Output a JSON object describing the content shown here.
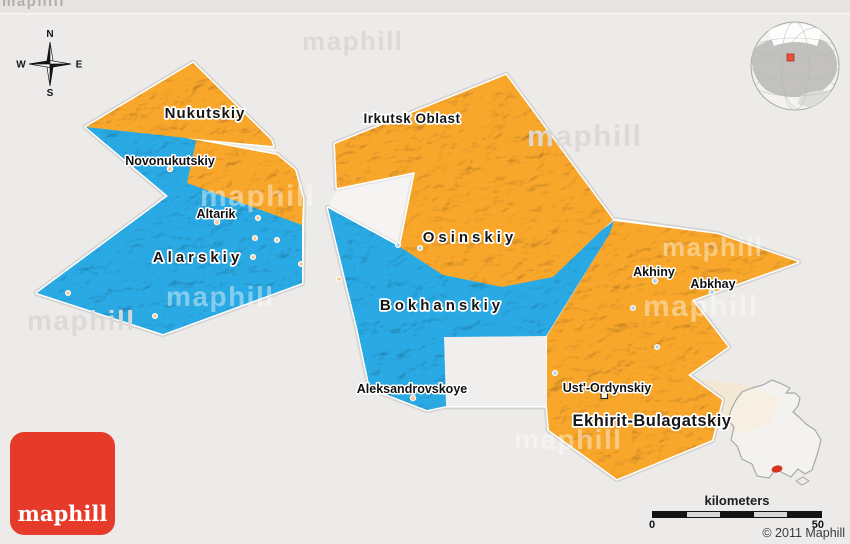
{
  "compass": {
    "n": "N",
    "e": "E",
    "s": "S",
    "w": "W"
  },
  "map_labels": {
    "districts": [
      {
        "name": "Nukutskiy"
      },
      {
        "name": "Irkutsk Oblast"
      },
      {
        "name": "Osinskiy"
      },
      {
        "name": "Alarskiy"
      },
      {
        "name": "Bokhanskiy"
      },
      {
        "name": "Ekhirit-Bulagatskiy"
      }
    ],
    "towns": [
      {
        "name": "Novonukutskiy"
      },
      {
        "name": "Altarik"
      },
      {
        "name": "Aleksandrovskoye"
      },
      {
        "name": "Akhiny"
      },
      {
        "name": "Abkhay"
      },
      {
        "name": "Ust'-Ordynskiy"
      }
    ]
  },
  "watermark_text": "maphill",
  "scale_bar": {
    "title": "kilometers",
    "start_label": "0",
    "end_label": "50"
  },
  "copyright_text": "© 2011 Maphill",
  "logo_text": "maphill",
  "colors": {
    "district_orange": "#f3a32b",
    "district_blue": "#2aa6df",
    "background": "#edebe9",
    "logo_red": "#e63a2b",
    "marker_red": "#d6341f"
  }
}
